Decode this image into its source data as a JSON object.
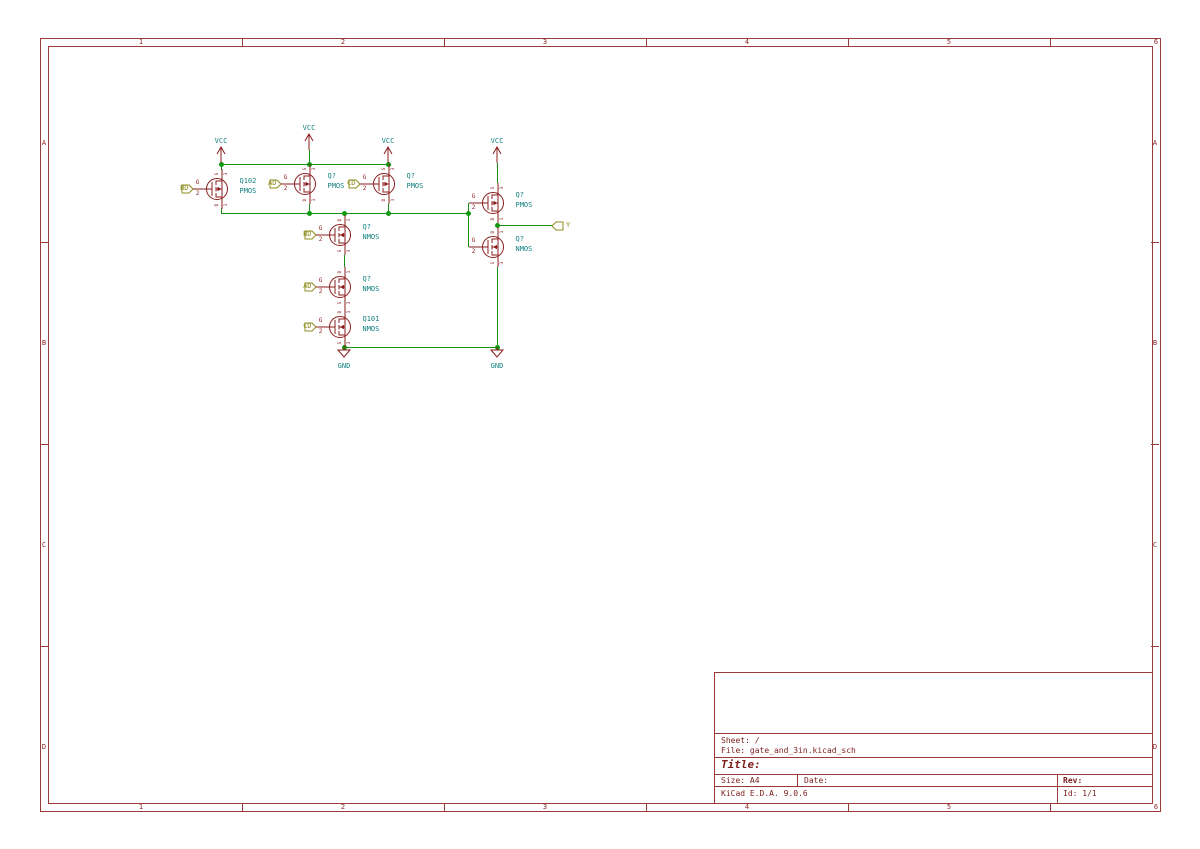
{
  "app": "KiCad E.D.A. schematic sheet",
  "sheet": {
    "grid_cols": [
      "1",
      "2",
      "3",
      "4",
      "5",
      "6"
    ],
    "grid_rows": [
      "A",
      "B",
      "C",
      "D"
    ],
    "title_block": {
      "sheet_label": "Sheet: /",
      "file_label": "File: gate_and_3in.kicad_sch",
      "title_label": "Title:",
      "size_label": "Size: A4",
      "date_label": "Date:",
      "rev_label": "Rev:",
      "app_label": "KiCad E.D.A. 9.0.6",
      "id_label": "Id: 1/1"
    }
  },
  "power": {
    "vcc_label": "VCC",
    "gnd_label": "GND"
  },
  "hier_labels": {
    "bd_pmos": "BD",
    "ad_pmos": "AD",
    "cd_pmos": "CD",
    "bd_nmos": "BD",
    "ad_nmos": "AD",
    "cd_nmos": "CD",
    "y_out": "Y"
  },
  "transistors": [
    {
      "ref": "Q102",
      "value": "PMOS",
      "type": "pmos",
      "gate": {
        "name": "G",
        "number": "2"
      },
      "top": {
        "name": "S",
        "number": "3"
      },
      "bottom": {
        "name": "D",
        "number": "1"
      }
    },
    {
      "ref": "Q?",
      "value": "PMOS",
      "type": "pmos",
      "gate": {
        "name": "G",
        "number": "2"
      },
      "top": {
        "name": "S",
        "number": "3"
      },
      "bottom": {
        "name": "D",
        "number": "1"
      }
    },
    {
      "ref": "Q?",
      "value": "PMOS",
      "type": "pmos",
      "gate": {
        "name": "G",
        "number": "2"
      },
      "top": {
        "name": "S",
        "number": "3"
      },
      "bottom": {
        "name": "D",
        "number": "1"
      }
    },
    {
      "ref": "Q?",
      "value": "PMOS",
      "type": "pmos",
      "gate": {
        "name": "G",
        "number": "2"
      },
      "top": {
        "name": "S",
        "number": "3"
      },
      "bottom": {
        "name": "D",
        "number": "1"
      }
    },
    {
      "ref": "Q?",
      "value": "NMOS",
      "type": "nmos",
      "gate": {
        "name": "G",
        "number": "2"
      },
      "top": {
        "name": "D",
        "number": "1"
      },
      "bottom": {
        "name": "S",
        "number": "3"
      }
    },
    {
      "ref": "Q?",
      "value": "NMOS",
      "type": "nmos",
      "gate": {
        "name": "G",
        "number": "2"
      },
      "top": {
        "name": "D",
        "number": "1"
      },
      "bottom": {
        "name": "S",
        "number": "3"
      }
    },
    {
      "ref": "Q101",
      "value": "NMOS",
      "type": "nmos",
      "gate": {
        "name": "G",
        "number": "2"
      },
      "top": {
        "name": "D",
        "number": "1"
      },
      "bottom": {
        "name": "S",
        "number": "3"
      }
    },
    {
      "ref": "Q?",
      "value": "NMOS",
      "type": "nmos",
      "gate": {
        "name": "G",
        "number": "2"
      },
      "top": {
        "name": "D",
        "number": "1"
      },
      "bottom": {
        "name": "S",
        "number": "3"
      }
    }
  ],
  "colors": {
    "wire_green": "#189018",
    "junction_green": "#0f9a0f",
    "symbol_red": "#8a1c1c",
    "value_teal": "#108080",
    "hier_olive": "#8d8d1e",
    "worksheet_red": "#9b3a3a"
  }
}
